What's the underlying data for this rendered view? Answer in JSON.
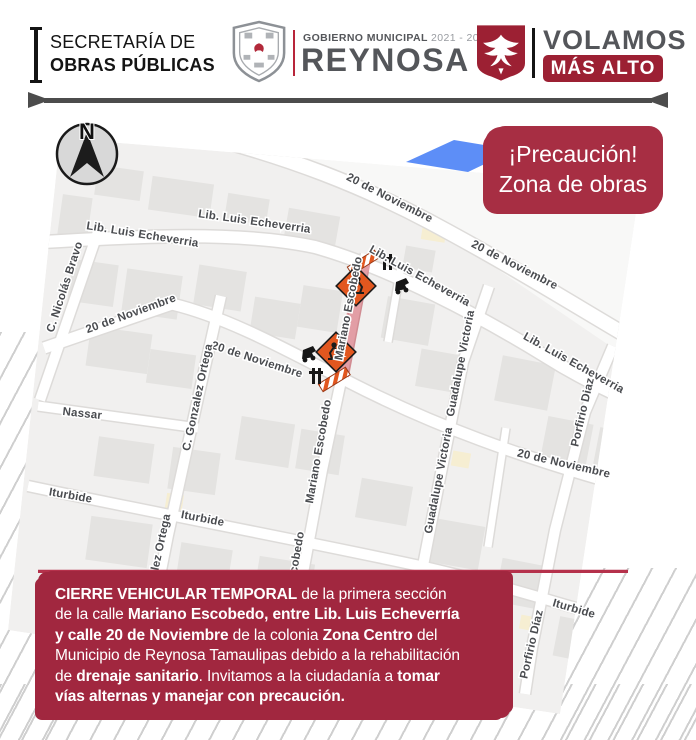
{
  "header": {
    "department": {
      "line1": "SECRETARÍA DE",
      "line2": "OBRAS PÚBLICAS"
    },
    "government": {
      "label": "GOBIERNO MUNICIPAL",
      "years": "2021 - 2024",
      "city": "REYNOSA"
    },
    "slogan": {
      "word": "VOLAMOS",
      "tagline": "MÁS ALTO"
    }
  },
  "badge": {
    "line1": "¡Precaución!",
    "line2": "Zona de obras"
  },
  "compass": {
    "label": "N"
  },
  "map": {
    "street_labels": [
      {
        "text": "20 de Noviembre",
        "x": 388,
        "y": 201,
        "a": 27
      },
      {
        "text": "20 de Noviembre",
        "x": 513,
        "y": 268,
        "a": 27
      },
      {
        "text": "Lib. Luis Echeverria",
        "x": 142,
        "y": 238,
        "a": 9
      },
      {
        "text": "Lib. Luis Echeverria",
        "x": 254,
        "y": 225,
        "a": 8
      },
      {
        "text": "Lib. Luis Echeverria",
        "x": 418,
        "y": 279,
        "a": 29
      },
      {
        "text": "Lib. Luis Echeverria",
        "x": 572,
        "y": 366,
        "a": 29
      },
      {
        "text": "C. Nicolás Bravo",
        "x": 68,
        "y": 288,
        "a": -72
      },
      {
        "text": "20 de Noviembre",
        "x": 132,
        "y": 317,
        "a": -20
      },
      {
        "text": "20 de Noviembre",
        "x": 256,
        "y": 363,
        "a": 18
      },
      {
        "text": "20 de Noviembre",
        "x": 563,
        "y": 467,
        "a": 13
      },
      {
        "text": "Mariano Escobedo",
        "x": 352,
        "y": 309,
        "a": -79
      },
      {
        "text": "Mariano Escobedo",
        "x": 322,
        "y": 452,
        "a": -80
      },
      {
        "text": "Mariano Escobedo",
        "x": 295,
        "y": 584,
        "a": -80
      },
      {
        "text": "C. Gonzalez Ortega",
        "x": 201,
        "y": 398,
        "a": -78
      },
      {
        "text": "C. Gonzalez Ortega",
        "x": 159,
        "y": 568,
        "a": -78
      },
      {
        "text": "Nassar",
        "x": 82,
        "y": 417,
        "a": 6
      },
      {
        "text": "Iturbide",
        "x": 70,
        "y": 499,
        "a": 10
      },
      {
        "text": "Iturbide",
        "x": 202,
        "y": 522,
        "a": 11
      },
      {
        "text": "Iturbide",
        "x": 573,
        "y": 612,
        "a": 16
      },
      {
        "text": "Guadalupe Victoria",
        "x": 464,
        "y": 364,
        "a": -79
      },
      {
        "text": "Guadalupe Victoria",
        "x": 442,
        "y": 481,
        "a": -79
      },
      {
        "text": "Porfirio Diaz",
        "x": 586,
        "y": 413,
        "a": -77
      },
      {
        "text": "Porfirio Díaz",
        "x": 535,
        "y": 645,
        "a": -77
      }
    ]
  },
  "notice": {
    "lines": [
      [
        {
          "t": "CIERRE VEHICULAR TEMPORAL",
          "b": true
        },
        {
          "t": " de la primera sección",
          "b": false
        }
      ],
      [
        {
          "t": "de la calle ",
          "b": false
        },
        {
          "t": "Mariano Escobedo, entre Lib. Luis Echeverría",
          "b": true
        }
      ],
      [
        {
          "t": "y calle 20 de Noviembre",
          "b": true
        },
        {
          "t": " de la colonia ",
          "b": false
        },
        {
          "t": "Zona Centro",
          "b": true
        },
        {
          "t": " del",
          "b": false
        }
      ],
      [
        {
          "t": "Municipio de Reynosa Tamaulipas debido a la rehabilitación",
          "b": false
        }
      ],
      [
        {
          "t": "de ",
          "b": false
        },
        {
          "t": "drenaje sanitario",
          "b": true
        },
        {
          "t": ". Invitamos a la ciudadanía a ",
          "b": false
        },
        {
          "t": "tomar",
          "b": true
        }
      ],
      [
        {
          "t": "vías alternas y manejar con precaución.",
          "b": true
        }
      ]
    ]
  },
  "colors": {
    "maroon_dark": "#9c2033",
    "badge_red": "#a72e43",
    "notice_red": "#a1273f",
    "divider_gray": "#4c4c4c",
    "closure_pink": "#c53e4c",
    "construction_orange": "#e2571f",
    "route_blue": "#5d8ef7"
  }
}
